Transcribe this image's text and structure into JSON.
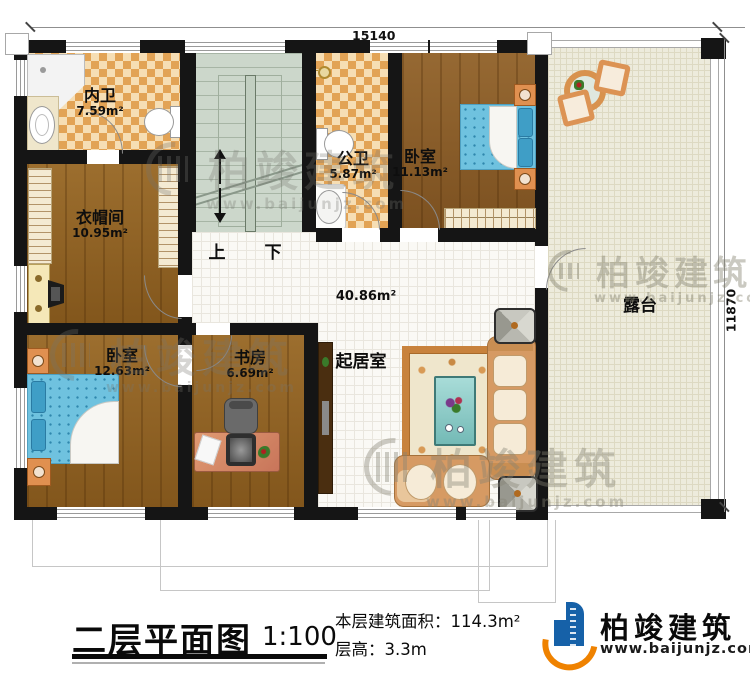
{
  "dimensions": {
    "top": "15140",
    "right": "11870"
  },
  "rooms": [
    {
      "id": "bath-ensuite",
      "name": "内卫",
      "area": "7.59m²"
    },
    {
      "id": "cloakroom",
      "name": "衣帽间",
      "area": "10.95m²"
    },
    {
      "id": "bedroom-left",
      "name": "卧室",
      "area": "12.63m²"
    },
    {
      "id": "bath-public",
      "name": "公卫",
      "area": "5.87m²"
    },
    {
      "id": "bedroom-right",
      "name": "卧室",
      "area": "11.13m²"
    },
    {
      "id": "study",
      "name": "书房",
      "area": "6.69m²"
    },
    {
      "id": "living-room",
      "name": "起居室",
      "area": "40.86m²"
    },
    {
      "id": "terrace",
      "name": "露台"
    }
  ],
  "stairs": {
    "up": "上",
    "down": "下"
  },
  "title_block": {
    "title": "二层平面图",
    "scale": "1:100",
    "floor_area_label": "本层建筑面积：",
    "floor_area_value": "114.3m²",
    "floor_height_label": "层高：",
    "floor_height_value": "3.3m"
  },
  "brand": {
    "name": "柏竣建筑",
    "website": "www.baijunjz.com"
  },
  "watermark": {
    "name": "柏竣建筑",
    "website": "www.baijunjz.com"
  },
  "colors": {
    "wall": "#151515",
    "wood_floor": "#91601f",
    "tile_light": "#f6deb4",
    "tile_dark": "#e2a355",
    "stair_floor": "#ccd7cb",
    "living_floor": "#faf9f5",
    "terrace_floor": "#edebdc",
    "bed_blue": "#6fc2df",
    "sofa_tan": "#d69a63",
    "logo_blue": "#1661a8",
    "logo_orange": "#ef8200"
  }
}
